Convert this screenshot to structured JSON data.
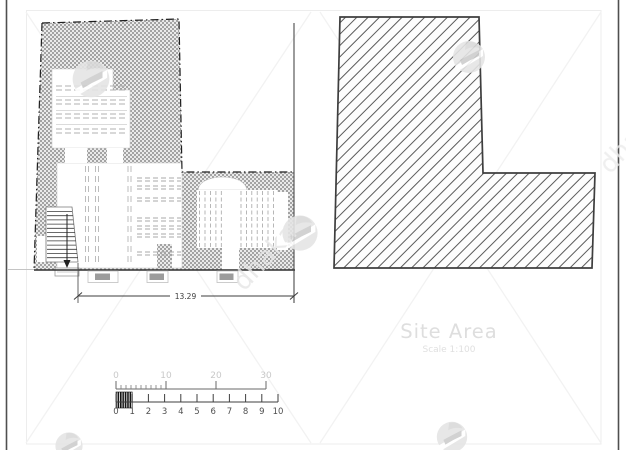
{
  "floor_plan": {
    "dimension_label": "13.29"
  },
  "site_area": {
    "title": "Site Area",
    "scale_label": "Scale 1:100"
  },
  "scale_bar": {
    "feet_labels": [
      "0",
      "10",
      "20",
      "30"
    ],
    "meter_labels": [
      "0",
      "1",
      "2",
      "3",
      "4",
      "5",
      "6",
      "7",
      "8",
      "9",
      "10"
    ]
  },
  "watermark": {
    "brand": "dhaka"
  },
  "colors": {
    "stipple_gray": "#a3a3a3",
    "hatch_line": "#5a5a5a",
    "boundary_line": "#1f1f1f",
    "shape_border": "#3e3e3e",
    "detail_dash": "#b0b0b0",
    "dimension_text": "#3c3c3c",
    "faint_text": "#dedede",
    "ruler_feet_text": "#c9c9c9",
    "ruler_meter_text": "#4f4f4f",
    "watermark_gray": "#e5e5e5",
    "page_edge": "#4f4f4f"
  }
}
